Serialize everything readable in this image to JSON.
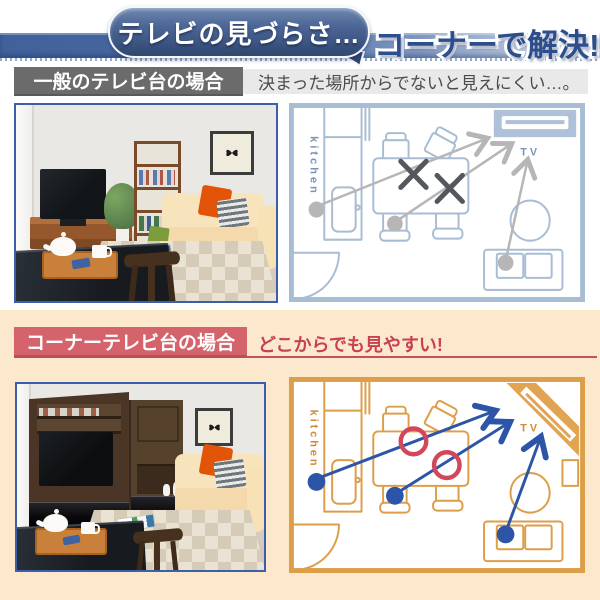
{
  "header": {
    "bubble_text": "テレビの見づらさ…",
    "solution_text": "コーナーで解決!"
  },
  "section_general": {
    "label": "一般のテレビ台の場合",
    "caption": "決まった場所からでないと見えにくい…。"
  },
  "section_corner": {
    "label": "コーナーテレビ台の場合",
    "caption": "どこからでも見やすい!"
  },
  "floorplan": {
    "kitchen_label": "kitchen",
    "tv_label": "TV"
  },
  "colors": {
    "banner_blue": "#44639a",
    "bubble_dark": "#2e4468",
    "solution_text_blue": "#2d4e8c",
    "general_label_gray": "#6b6b6b",
    "general_caption_bg": "#e9e9e9",
    "corner_label_red": "#d5636b",
    "corner_caption_red": "#c9404e",
    "cream_background": "#fce9cd",
    "plan_general_line": "#a8bdd4",
    "plan_general_arrow": "#b6b6b6",
    "plan_general_mark": "#54585e",
    "plan_corner_line": "#dd9e49",
    "plan_corner_arrow": "#2c55a8",
    "plan_corner_mark": "#d2485a",
    "photo_border_blue": "#3b5fa8"
  }
}
